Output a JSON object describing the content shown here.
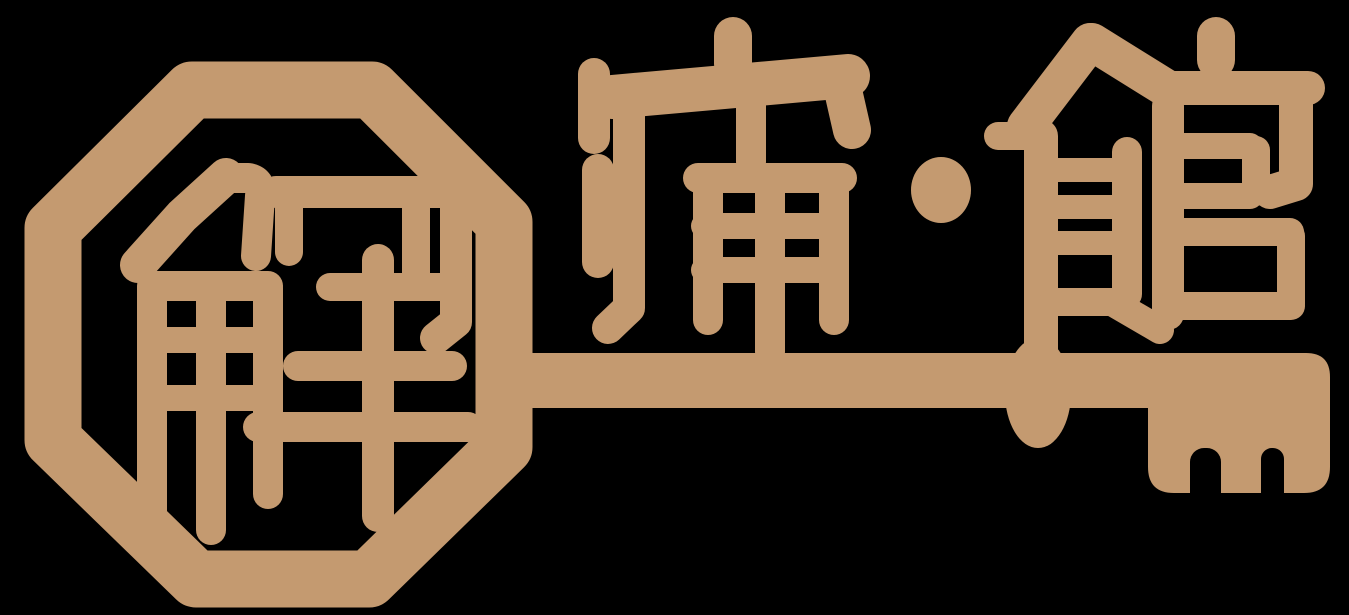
{
  "logo": {
    "full_name": "解痛館",
    "seal_character": "解",
    "character_pain": "痛",
    "character_hall": "館",
    "separator_dot": "·"
  },
  "colors": {
    "background": "#000000",
    "brand_tan": "#c49a70"
  }
}
